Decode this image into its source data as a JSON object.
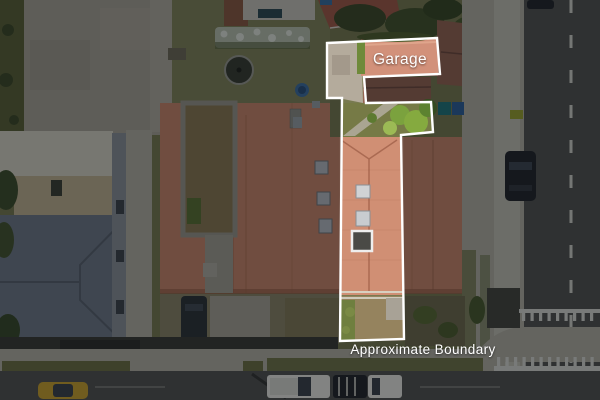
{
  "scene": {
    "description": "Aerial drone photograph of a residential property with highlighted lot",
    "labels": {
      "garage": "Garage",
      "approximate_boundary": "Approximate Boundary"
    }
  },
  "colors": {
    "boundary_line": "#ffffff",
    "label_text": "#ffffff",
    "roof_salmon": "#c9866a",
    "roof_salmon_bright": "#d08f74",
    "garage_roof": "#d2917a",
    "neighbor_brown_roof": "#956452",
    "left_house_slate": "#6f7987",
    "left_house_light": "#d6d2c4",
    "left_house_tan": "#c0b190",
    "grass": "#787a50",
    "lawn": "#82845a",
    "tree_green": "#7ba23e",
    "concrete": "#b4ab9c",
    "sidewalk": "#b2afa2",
    "road": "#525250",
    "dirt": "#95835e",
    "courtyard_dirt": "#8a7852",
    "yellow_car": "#c9a02e",
    "white_vehicle": "#e9e8e2",
    "dark_vehicle": "#23262b",
    "dim_overlay": "rgba(5,9,13,0.45)"
  }
}
